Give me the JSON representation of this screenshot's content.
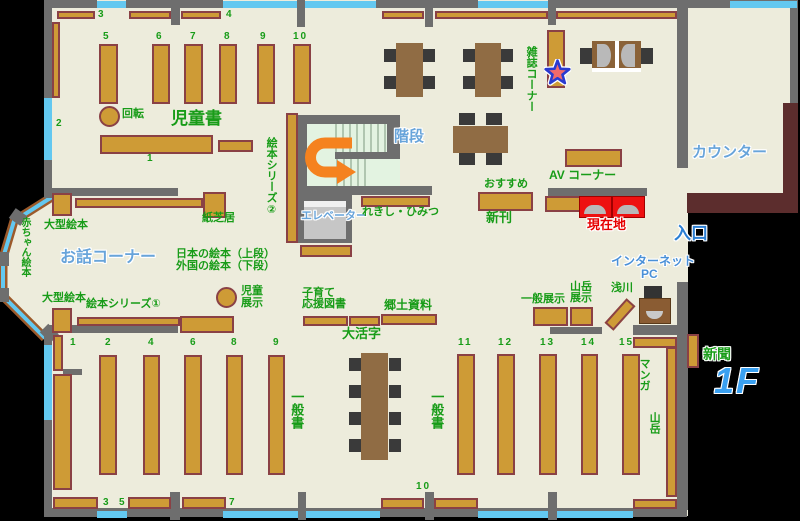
{
  "floor_badge": "1F",
  "areas": {
    "children_books": "児童書",
    "story_corner": "お話コーナー",
    "stairs": "階段",
    "elevator": "エレベーター",
    "counter": "カウンター",
    "entrance": "入口",
    "internet_line1": "インターネット",
    "internet_line2": "PC",
    "magazine_corner": "雑誌コーナー",
    "av_corner": "AV コーナー",
    "you_are_here": "現在地",
    "newspaper": "新聞",
    "general_books": "一般書"
  },
  "shelves": {
    "rotation": "回転",
    "picture_book_series_2": "絵本シリーズ②",
    "kamishibai": "紙芝居",
    "large_picture_books": "大型絵本",
    "baby_picture_books": "赤ちゃん絵本",
    "japanese_picture_books": "日本の絵本（上段）",
    "foreign_picture_books": "外国の絵本（下段）",
    "children_display_1": "児童",
    "children_display_2": "展示",
    "picture_book_series_1": "絵本シリーズ①",
    "history_secrets": "れきし・ひみつ",
    "recommended": "おすすめ",
    "new_arrivals": "新刊",
    "parenting_1": "子育て",
    "parenting_2": "応援図書",
    "large_print": "大活字",
    "local_materials": "郷土資料",
    "general_display": "一般展示",
    "mountain_display_1": "山岳",
    "mountain_display_2": "展示",
    "asakawa": "浅川",
    "manga": "マンガ",
    "mountain": "山岳"
  },
  "numbers": {
    "children_top": [
      "3",
      "4"
    ],
    "children_cols": [
      "5",
      "6",
      "7",
      "8",
      "9",
      "10"
    ],
    "children_left": "2",
    "children_center": "1",
    "general_left": [
      "1",
      "2",
      "4",
      "6",
      "8",
      "9"
    ],
    "general_left_bottom": [
      "3",
      "5",
      "7"
    ],
    "general_right": [
      "11",
      "12",
      "13",
      "14",
      "15"
    ],
    "general_right_bottom": "10"
  },
  "colors": {
    "shelf": "#ce9b36",
    "shelf_border": "#8a4145",
    "wall": "#6e6e6e",
    "window": "#63c8f0",
    "floor": "#edecdc",
    "counter_desk": "#5c2d2d",
    "green_label": "#189c18",
    "blue_label": "#68a4da",
    "accent_blue": "#2b7fd4",
    "red_label": "#e60000",
    "arrow_orange": "#f5821f",
    "star_fill": "#f26a6a"
  }
}
